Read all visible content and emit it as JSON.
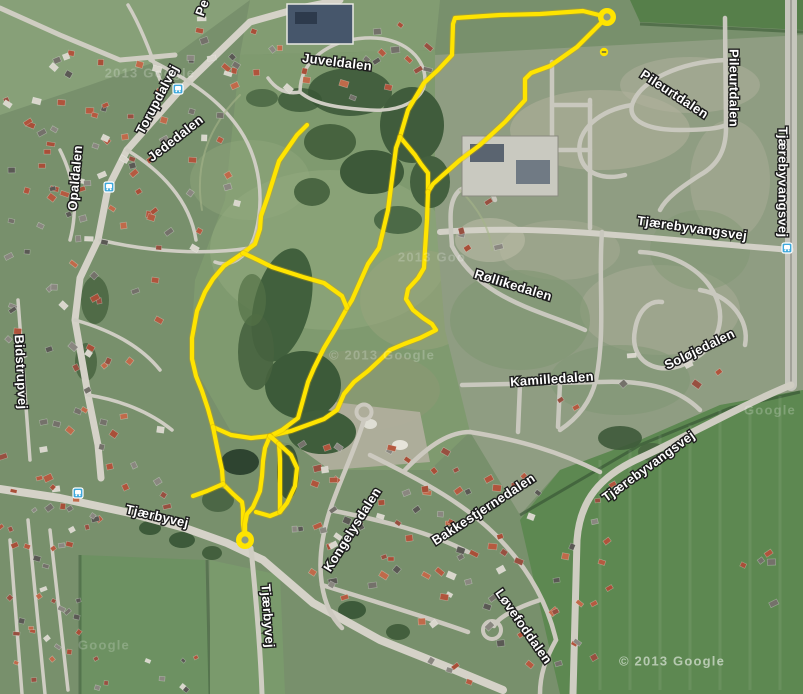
{
  "map": {
    "kind": "satellite-map-with-gps-route",
    "labels": [
      {
        "text": "Juveldalen",
        "x": 337,
        "y": 63,
        "rot": 7
      },
      {
        "text": "Torupdalvej",
        "x": 158,
        "y": 100,
        "rot": -62
      },
      {
        "text": "Jededalen",
        "x": 176,
        "y": 139,
        "rot": -38
      },
      {
        "text": "Opaldalen",
        "x": 76,
        "y": 178,
        "rot": -85
      },
      {
        "text": "Pe",
        "x": 203,
        "y": 8,
        "rot": -70
      },
      {
        "text": "Pileurtdalen",
        "x": 674,
        "y": 95,
        "rot": 33
      },
      {
        "text": "Pileurtdalen",
        "x": 733,
        "y": 88,
        "rot": 90
      },
      {
        "text": "Tjærebyvangsvej",
        "x": 782,
        "y": 182,
        "rot": 90
      },
      {
        "text": "Tjærebyvangsvej",
        "x": 692,
        "y": 229,
        "rot": 8
      },
      {
        "text": "Tjærebyvangsvej",
        "x": 649,
        "y": 467,
        "rot": -36
      },
      {
        "text": "Røllikedalen",
        "x": 513,
        "y": 286,
        "rot": 17
      },
      {
        "text": "Soløjedalen",
        "x": 700,
        "y": 350,
        "rot": -26
      },
      {
        "text": "Kamilledalen",
        "x": 552,
        "y": 380,
        "rot": -4
      },
      {
        "text": "Tjærbyvej",
        "x": 157,
        "y": 517,
        "rot": 13
      },
      {
        "text": "Tjærbyvej",
        "x": 267,
        "y": 616,
        "rot": 86
      },
      {
        "text": "Kongelysdalen",
        "x": 353,
        "y": 530,
        "rot": -58
      },
      {
        "text": "Bakkestjernedalen",
        "x": 484,
        "y": 510,
        "rot": -33
      },
      {
        "text": "Løvefoddalen",
        "x": 523,
        "y": 627,
        "rot": 55
      },
      {
        "text": "Bidstrupvej",
        "x": 20,
        "y": 372,
        "rot": 87
      }
    ],
    "watermarks": [
      {
        "text": "© 2013 Google",
        "x": 672,
        "y": 662,
        "opacity": 0.55,
        "size": 14
      },
      {
        "text": "2013 Google",
        "x": 150,
        "y": 74,
        "opacity": 0.22,
        "size": 13
      },
      {
        "text": "© 2013 Google",
        "x": 382,
        "y": 356,
        "opacity": 0.22,
        "size": 13
      },
      {
        "text": "2013 Goo",
        "x": 432,
        "y": 258,
        "opacity": 0.2,
        "size": 13
      },
      {
        "text": "Google",
        "x": 104,
        "y": 646,
        "opacity": 0.2,
        "size": 13
      },
      {
        "text": "Google",
        "x": 770,
        "y": 411,
        "opacity": 0.22,
        "size": 13
      }
    ],
    "bus_stops": [
      {
        "x": 178,
        "y": 89
      },
      {
        "x": 109,
        "y": 187
      },
      {
        "x": 78,
        "y": 493
      },
      {
        "x": 787,
        "y": 248
      }
    ],
    "route": {
      "color": "#ffe400",
      "edge_color": "#cfa900",
      "width": 4.2,
      "polylines": [
        [
          [
            607,
            17
          ],
          [
            583,
            11
          ],
          [
            540,
            14
          ],
          [
            500,
            15
          ],
          [
            455,
            18
          ],
          [
            453,
            24
          ],
          [
            452,
            55
          ],
          [
            438,
            70
          ],
          [
            424,
            83
          ],
          [
            408,
            110
          ],
          [
            400,
            137
          ]
        ],
        [
          [
            400,
            137
          ],
          [
            415,
            155
          ],
          [
            421,
            164
          ],
          [
            428,
            173
          ],
          [
            428,
            192
          ]
        ],
        [
          [
            607,
            17
          ],
          [
            577,
            47
          ],
          [
            550,
            66
          ],
          [
            531,
            73
          ],
          [
            525,
            79
          ],
          [
            525,
            100
          ],
          [
            505,
            122
          ],
          [
            480,
            145
          ],
          [
            460,
            160
          ],
          [
            443,
            175
          ],
          [
            433,
            184
          ],
          [
            428,
            192
          ]
        ],
        [
          [
            428,
            192
          ],
          [
            427,
            220
          ],
          [
            425,
            250
          ],
          [
            424,
            268
          ],
          [
            418,
            278
          ],
          [
            408,
            289
          ],
          [
            406,
            299
          ],
          [
            413,
            310
          ],
          [
            423,
            318
          ],
          [
            432,
            324
          ],
          [
            436,
            330
          ],
          [
            420,
            338
          ],
          [
            404,
            344
          ],
          [
            390,
            350
          ],
          [
            382,
            358
          ],
          [
            368,
            371
          ],
          [
            354,
            382
          ],
          [
            344,
            394
          ],
          [
            337,
            410
          ],
          [
            324,
            419
          ],
          [
            291,
            431
          ],
          [
            270,
            436
          ]
        ],
        [
          [
            400,
            137
          ],
          [
            396,
            148
          ],
          [
            388,
            210
          ],
          [
            379,
            248
          ],
          [
            368,
            264
          ],
          [
            352,
            300
          ],
          [
            347,
            308
          ],
          [
            336,
            328
          ],
          [
            324,
            348
          ],
          [
            314,
            368
          ],
          [
            308,
            382
          ],
          [
            303,
            400
          ],
          [
            298,
            418
          ],
          [
            282,
            430
          ],
          [
            270,
            436
          ]
        ],
        [
          [
            307,
            125
          ],
          [
            297,
            135
          ],
          [
            279,
            161
          ],
          [
            268,
            196
          ],
          [
            261,
            216
          ],
          [
            260,
            229
          ],
          [
            255,
            244
          ],
          [
            243,
            253
          ],
          [
            224,
            266
          ],
          [
            213,
            279
          ],
          [
            205,
            292
          ],
          [
            197,
            311
          ],
          [
            192,
            338
          ],
          [
            192,
            359
          ],
          [
            196,
            376
          ],
          [
            202,
            391
          ],
          [
            208,
            409
          ],
          [
            213,
            427
          ],
          [
            231,
            435
          ],
          [
            251,
            438
          ],
          [
            270,
            436
          ]
        ],
        [
          [
            243,
            253
          ],
          [
            258,
            260
          ],
          [
            272,
            267
          ],
          [
            303,
            277
          ],
          [
            324,
            283
          ],
          [
            342,
            296
          ],
          [
            347,
            308
          ]
        ],
        [
          [
            213,
            427
          ],
          [
            217,
            447
          ],
          [
            222,
            470
          ],
          [
            223,
            484
          ],
          [
            233,
            494
          ],
          [
            242,
            502
          ],
          [
            243,
            509
          ],
          [
            243,
            524
          ],
          [
            245,
            539
          ]
        ],
        [
          [
            223,
            484
          ],
          [
            207,
            491
          ],
          [
            193,
            496
          ]
        ],
        [
          [
            270,
            436
          ],
          [
            265,
            448
          ],
          [
            263,
            461
          ],
          [
            262,
            476
          ],
          [
            260,
            491
          ],
          [
            253,
            507
          ],
          [
            247,
            514
          ],
          [
            245,
            524
          ],
          [
            245,
            539
          ]
        ],
        [
          [
            270,
            436
          ],
          [
            279,
            444
          ],
          [
            280,
            459
          ],
          [
            280,
            478
          ],
          [
            280,
            498
          ],
          [
            280,
            512
          ],
          [
            270,
            516
          ],
          [
            256,
            512
          ]
        ],
        [
          [
            279,
            444
          ],
          [
            291,
            455
          ],
          [
            297,
            468
          ],
          [
            295,
            486
          ],
          [
            287,
            503
          ],
          [
            280,
            512
          ]
        ]
      ],
      "markers": [
        {
          "x": 607,
          "y": 17
        },
        {
          "x": 245,
          "y": 540
        }
      ],
      "dot": {
        "x": 604,
        "y": 52
      }
    }
  }
}
